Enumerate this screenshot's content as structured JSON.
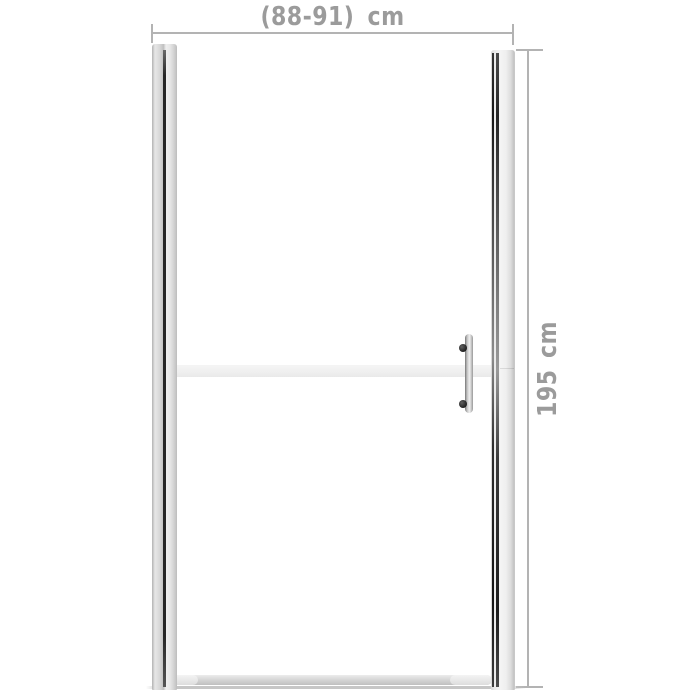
{
  "dimensions": {
    "width": {
      "label": "(88-91) cm"
    },
    "height": {
      "label": "195 cm"
    }
  },
  "colors": {
    "background": "#ffffff",
    "dimension_text": "#9b9b9b",
    "dimension_line": "#b3b3b3",
    "frame_dark_line": "#262626",
    "frosted_band": "#efefef",
    "handle_dark": "#1f1f1f"
  }
}
